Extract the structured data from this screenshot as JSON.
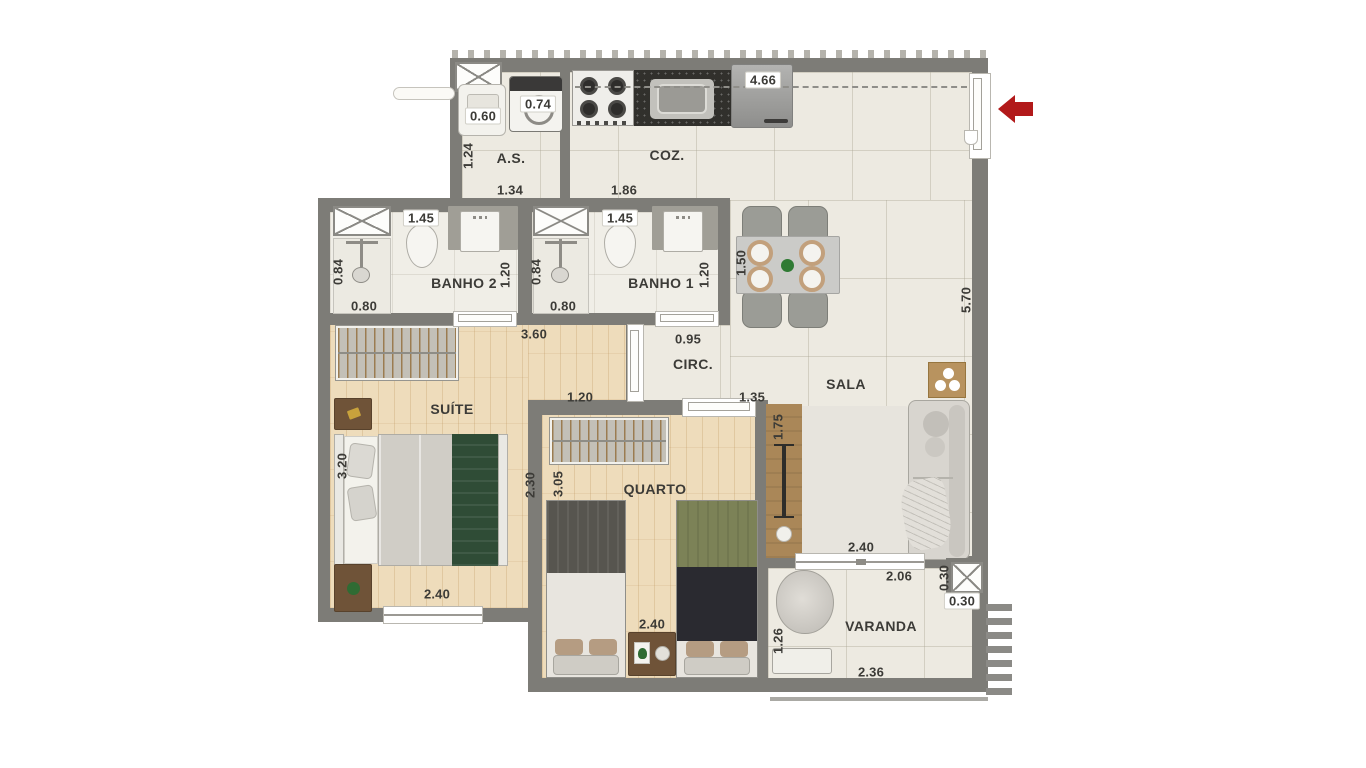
{
  "plan_title": "Apartment floor plan",
  "rooms": {
    "as": {
      "label": "A.S."
    },
    "coz": {
      "label": "COZ."
    },
    "banho2": {
      "label": "BANHO 2"
    },
    "banho1": {
      "label": "BANHO 1"
    },
    "circ": {
      "label": "CIRC."
    },
    "sala": {
      "label": "SALA"
    },
    "suite": {
      "label": "SUÍTE"
    },
    "quarto": {
      "label": "QUARTO"
    },
    "varanda": {
      "label": "VARANDA"
    }
  },
  "dimensions": [
    {
      "value": "0.60",
      "x": 483,
      "y": 116,
      "o": "h",
      "chip": true
    },
    {
      "value": "0.74",
      "x": 538,
      "y": 104,
      "o": "h",
      "chip": true
    },
    {
      "value": "4.66",
      "x": 763,
      "y": 80,
      "o": "h",
      "chip": true
    },
    {
      "value": "1.24",
      "x": 468,
      "y": 156,
      "o": "v",
      "chip": false
    },
    {
      "value": "1.34",
      "x": 510,
      "y": 190,
      "o": "h",
      "chip": false
    },
    {
      "value": "1.86",
      "x": 624,
      "y": 190,
      "o": "h",
      "chip": false
    },
    {
      "value": "1.45",
      "x": 421,
      "y": 218,
      "o": "h",
      "chip": true
    },
    {
      "value": "1.45",
      "x": 620,
      "y": 218,
      "o": "h",
      "chip": true
    },
    {
      "value": "0.84",
      "x": 338,
      "y": 272,
      "o": "v",
      "chip": false
    },
    {
      "value": "0.84",
      "x": 536,
      "y": 272,
      "o": "v",
      "chip": false
    },
    {
      "value": "1.20",
      "x": 505,
      "y": 275,
      "o": "v",
      "chip": false
    },
    {
      "value": "1.20",
      "x": 704,
      "y": 275,
      "o": "v",
      "chip": false
    },
    {
      "value": "0.80",
      "x": 364,
      "y": 306,
      "o": "h",
      "chip": false
    },
    {
      "value": "0.80",
      "x": 563,
      "y": 306,
      "o": "h",
      "chip": false
    },
    {
      "value": "3.60",
      "x": 534,
      "y": 334,
      "o": "h",
      "chip": false
    },
    {
      "value": "0.95",
      "x": 688,
      "y": 339,
      "o": "h",
      "chip": false
    },
    {
      "value": "1.50",
      "x": 741,
      "y": 263,
      "o": "v",
      "chip": false
    },
    {
      "value": "5.70",
      "x": 966,
      "y": 300,
      "o": "v",
      "chip": false
    },
    {
      "value": "1.20",
      "x": 580,
      "y": 397,
      "o": "h",
      "chip": false
    },
    {
      "value": "1.35",
      "x": 752,
      "y": 397,
      "o": "h",
      "chip": false
    },
    {
      "value": "1.75",
      "x": 778,
      "y": 427,
      "o": "v",
      "chip": false
    },
    {
      "value": "3.20",
      "x": 342,
      "y": 466,
      "o": "v",
      "chip": false
    },
    {
      "value": "2.30",
      "x": 530,
      "y": 485,
      "o": "v",
      "chip": false
    },
    {
      "value": "3.05",
      "x": 558,
      "y": 484,
      "o": "v",
      "chip": false
    },
    {
      "value": "2.40",
      "x": 437,
      "y": 594,
      "o": "h",
      "chip": false
    },
    {
      "value": "2.40",
      "x": 861,
      "y": 547,
      "o": "h",
      "chip": false
    },
    {
      "value": "2.06",
      "x": 899,
      "y": 576,
      "o": "h",
      "chip": false
    },
    {
      "value": "0.30",
      "x": 944,
      "y": 578,
      "o": "v",
      "chip": false
    },
    {
      "value": "0.30",
      "x": 962,
      "y": 601,
      "o": "h",
      "chip": true
    },
    {
      "value": "2.40",
      "x": 652,
      "y": 624,
      "o": "h",
      "chip": false
    },
    {
      "value": "1.26",
      "x": 778,
      "y": 641,
      "o": "v",
      "chip": false
    },
    {
      "value": "2.36",
      "x": 871,
      "y": 672,
      "o": "h",
      "chip": false
    }
  ],
  "colors": {
    "wall": "#7d7c77",
    "tile_floor": "#edeae1",
    "wood_floor": "#eedcbb",
    "entry_arrow": "#b2191a",
    "dark_counter": "#31302c",
    "green_blanket": "#2f4c36"
  }
}
